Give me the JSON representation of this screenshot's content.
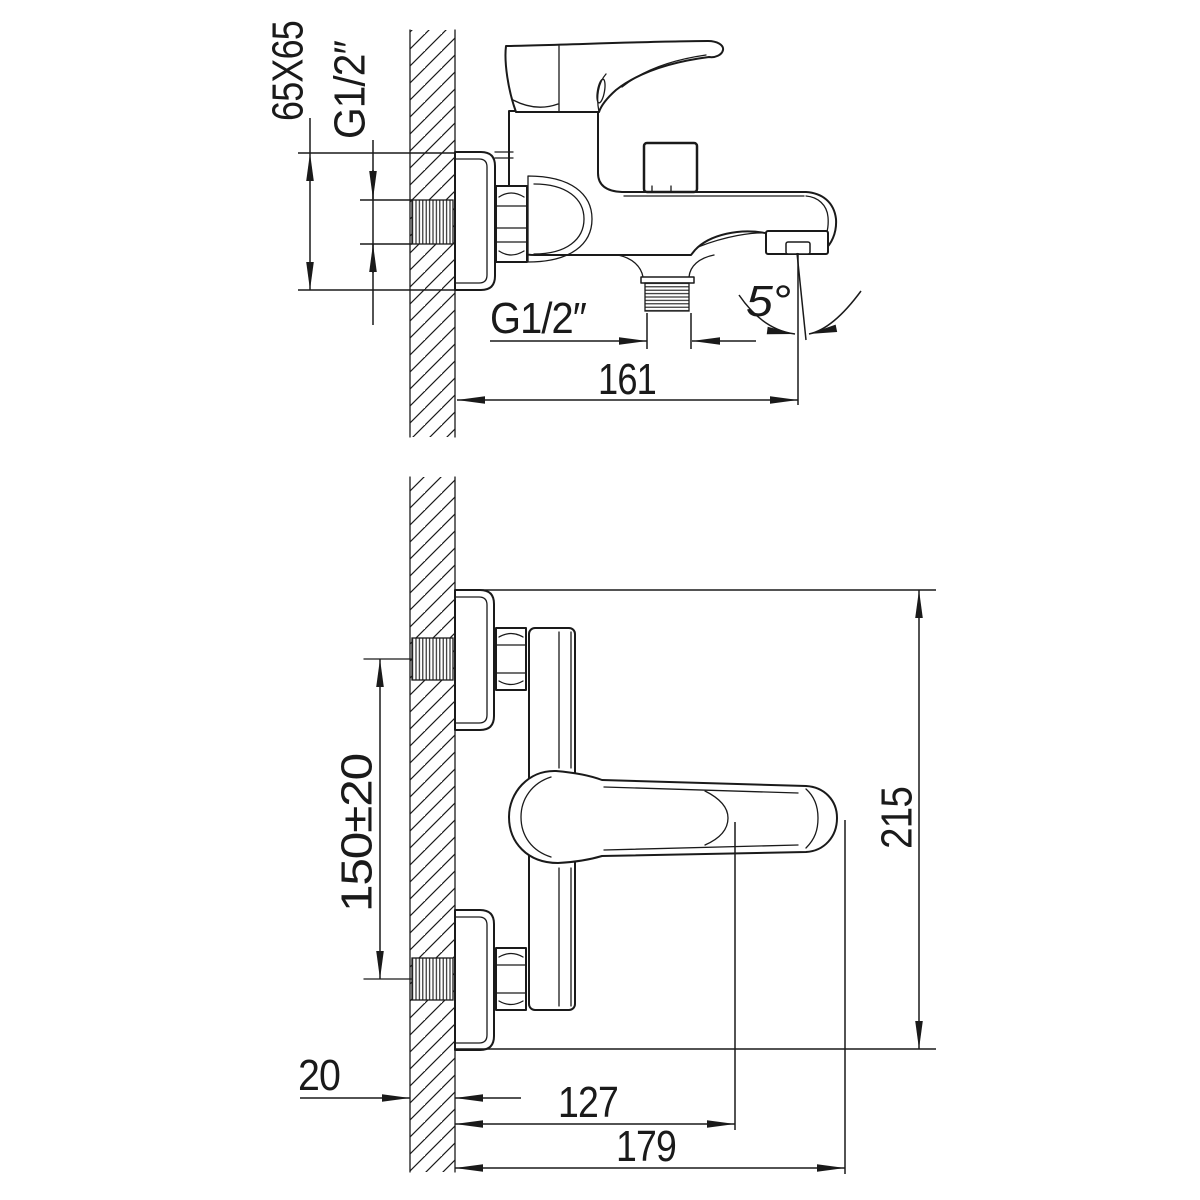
{
  "drawing": {
    "kind": "faucet installation dimensional drawing",
    "colors": {
      "line": "#1a1a1a",
      "background": "#ffffff"
    },
    "dimensions": {
      "side_view": {
        "escutcheon_square": "65X65",
        "inlet_thread": "G1/2″",
        "outlet_thread": "G1/2″",
        "spout_reach": "161",
        "spout_angle": "5°"
      },
      "front_view": {
        "inlet_spacing": "150±20",
        "overall_height": "215",
        "wall_thickness": "20",
        "handle_reach": "127",
        "overall_depth": "179"
      }
    }
  }
}
